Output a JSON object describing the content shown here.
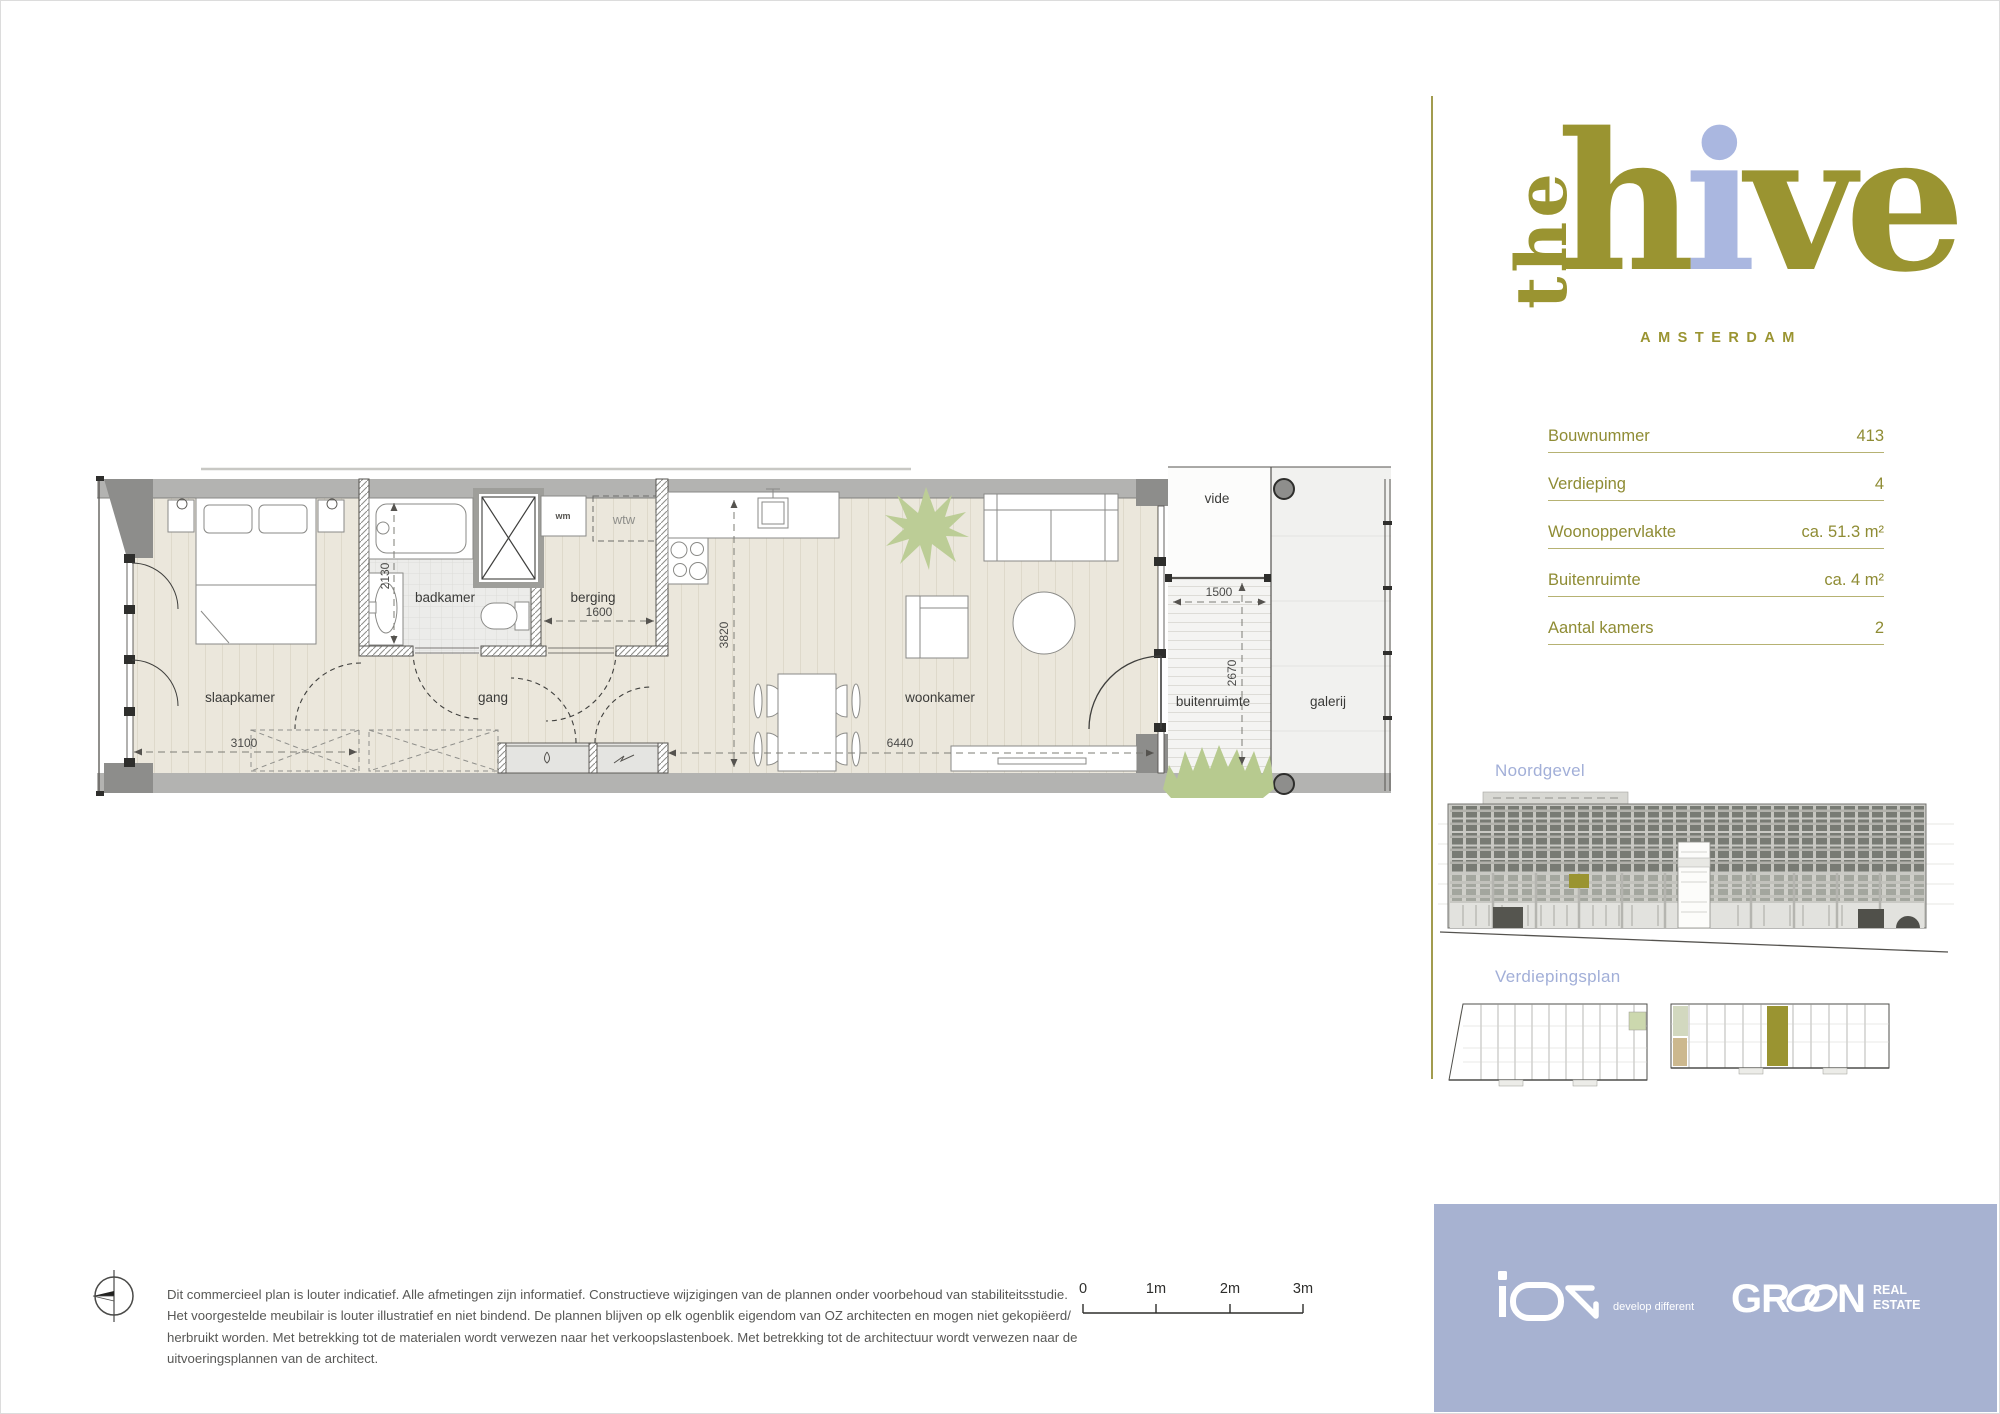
{
  "brand": {
    "the": "the",
    "h": "h",
    "i": "i",
    "ve": "ve",
    "city": "AMSTERDAM"
  },
  "specs": {
    "rows": [
      {
        "label": "Bouwnummer",
        "value": "413"
      },
      {
        "label": "Verdieping",
        "value": "4"
      },
      {
        "label": "Woonoppervlakte",
        "value": "ca. 51.3 m²"
      },
      {
        "label": "Buitenruimte",
        "value": "ca. 4 m²"
      },
      {
        "label": "Aantal kamers",
        "value": "2"
      }
    ]
  },
  "sections": {
    "facade": "Noordgevel",
    "floor": "Verdiepingsplan"
  },
  "plan": {
    "labels": {
      "bedroom": "slaapkamer",
      "bathroom": "badkamer",
      "storage": "berging",
      "hallway": "gang",
      "living": "woonkamer",
      "outdoor": "buitenruimte",
      "gallery": "galerij",
      "void": "vide",
      "washer": "wm",
      "heat_unit": "wtw"
    },
    "dims": {
      "bedroom_w": "3100",
      "bathroom_d": "2130",
      "storage_w": "1600",
      "living_d": "3820",
      "living_w": "6440",
      "outdoor_w": "1500",
      "outdoor_d": "2670"
    }
  },
  "scalebar": {
    "labels": [
      "0",
      "1m",
      "2m",
      "3m"
    ]
  },
  "disclaimer": {
    "lines": [
      "Dit commercieel plan is louter indicatief. Alle afmetingen zijn informatief. Constructieve wijzigingen van de plannen onder voorbehoud van stabiliteitsstudie.",
      "Het voorgestelde meubilair is louter illustratief en niet bindend. De plannen blijven op elk ogenblik eigendom van OZ architecten en mogen niet gekopiëerd/",
      "herbruikt worden. Met betrekking tot de materialen wordt verwezen naar het verkoopslastenboek. Met betrekking tot de architectuur wordt verwezen naar de",
      "uitvoeringsplannen van de architect."
    ]
  },
  "footer": {
    "ion_tagline": "develop different",
    "green_gr": "GR",
    "green_n": "N",
    "real": "REAL",
    "estate": "ESTATE"
  },
  "colors": {
    "olive": "#9a9431",
    "olive_text": "#8f8c34",
    "rule": "#b6b273",
    "periwinkle": "#a2afd8",
    "periwinkle_light": "#aab7e0",
    "lavender": "#a7b2d1",
    "divider": "#a29c4f"
  }
}
